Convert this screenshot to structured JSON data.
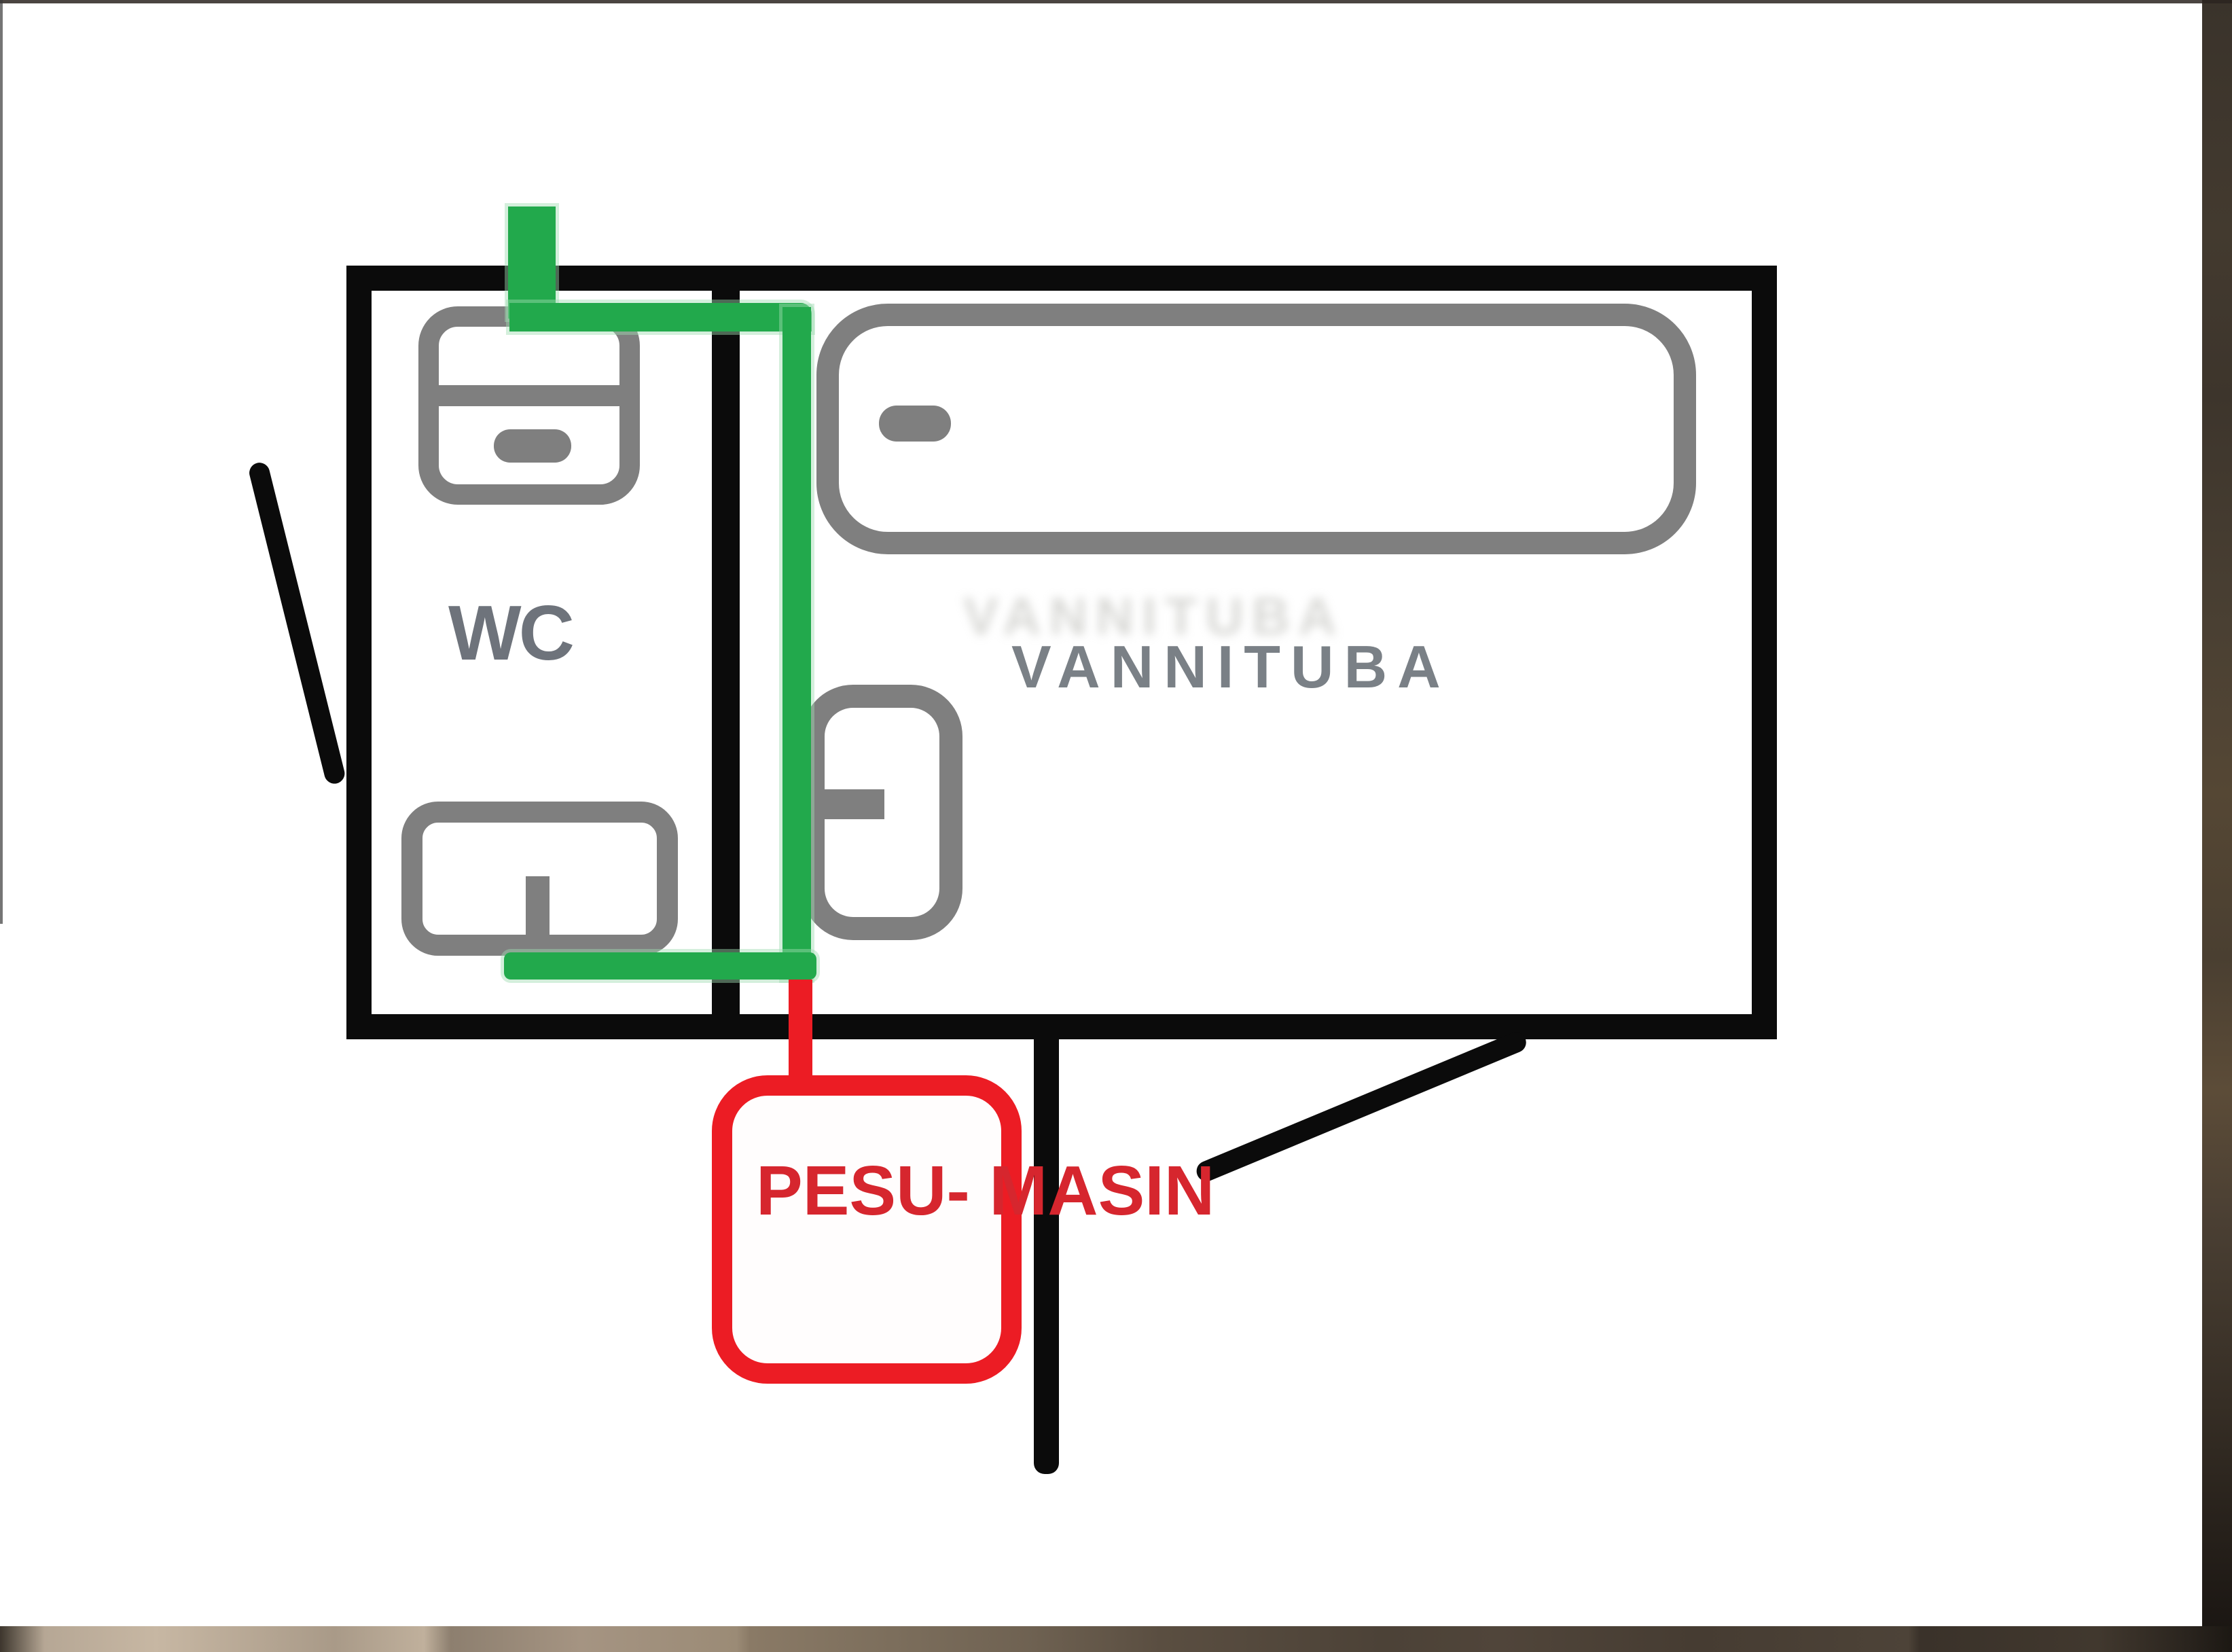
{
  "document": {
    "kind": "hand-drawn bathroom floor plan sketch",
    "rooms": [
      {
        "name": "WC"
      },
      {
        "name": "VANNITUBA"
      }
    ],
    "annotation_box": {
      "line1": "PESU-",
      "line2": "MASIN"
    }
  },
  "labels": {
    "wc": "WC",
    "room": "VANNITUBA",
    "ghost": "VANNITUBA",
    "machine": "PESU-\nMASIN"
  },
  "colors": {
    "wall": "#0b0b0b",
    "fixture": "#7f7f7f",
    "route": "#22a94c",
    "annotation": "#ec1c24",
    "annotation_text": "#d6262e",
    "label_text": "#6e737b",
    "label_text_light": "#7a8086",
    "canvas_bg": "#ffffff",
    "photo_wood_dark": "#3a332b",
    "photo_wood_tan": "#b6a795"
  }
}
